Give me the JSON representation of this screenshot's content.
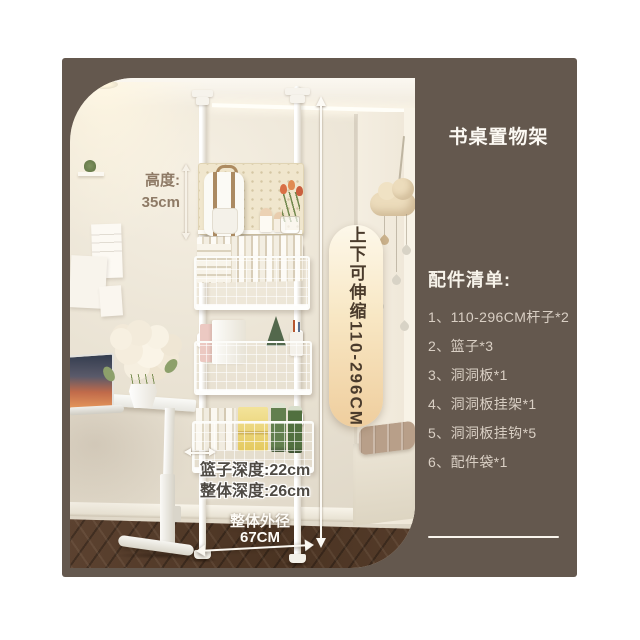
{
  "header": {
    "title": "书桌置物架"
  },
  "annotations": {
    "height": {
      "label": "高度:",
      "value": "35cm"
    },
    "range_pill": {
      "text": "上下可伸缩110-296CM"
    },
    "basket_depth": "篮子深度:22cm",
    "overall_depth": "整体深度:26cm",
    "overall_width": {
      "label": "整体外径",
      "value": "67CM"
    }
  },
  "accessory_list": {
    "heading": "配件清单:",
    "items": [
      "1、110-296CM杆子*2",
      "2、篮子*3",
      "3、洞洞板*1",
      "4、洞洞板挂架*1",
      "5、洞洞板挂钩*5",
      "6、配件袋*1"
    ]
  },
  "colors": {
    "panel_brown": "#64584e",
    "pill_gradient_top": "#fdf8ea",
    "pill_gradient_bottom": "#efce9e",
    "pill_text": "#4a3b2c",
    "height_label": "#8e7a66"
  }
}
